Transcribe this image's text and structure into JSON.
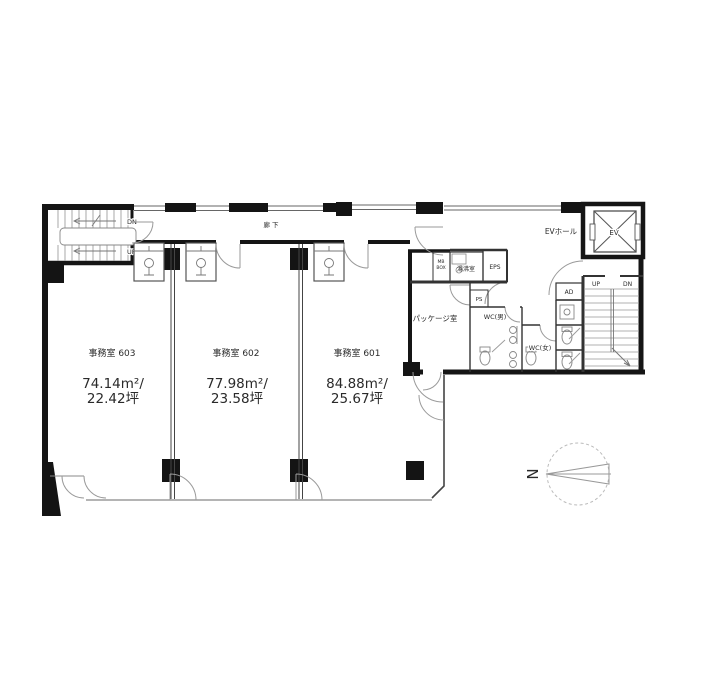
{
  "plan": {
    "corridor_label": "廊下",
    "rooms": [
      {
        "name": "事務室 603",
        "area_m2": "74.14m²/",
        "area_tsubo": "22.42坪"
      },
      {
        "name": "事務室 602",
        "area_m2": "77.98m²/",
        "area_tsubo": "23.58坪"
      },
      {
        "name": "事務室 601",
        "area_m2": "84.88m²/",
        "area_tsubo": "25.67坪"
      }
    ],
    "labels": {
      "ev_hall": "EVホール",
      "ev": "EV",
      "package_room": "パッケージ室",
      "hot_water_room": "湯沸室",
      "eps": "EPS",
      "ps": "PS",
      "ad": "AD",
      "wc_men": "WC(男)",
      "wc_women": "WC(女)",
      "mb_line1": "MB",
      "mb_line2": "BOX"
    },
    "stairs": {
      "left_dn": "DN",
      "left_up": "UP",
      "right_up": "UP",
      "right_dn": "DN"
    },
    "compass": {
      "letter": "N"
    }
  }
}
